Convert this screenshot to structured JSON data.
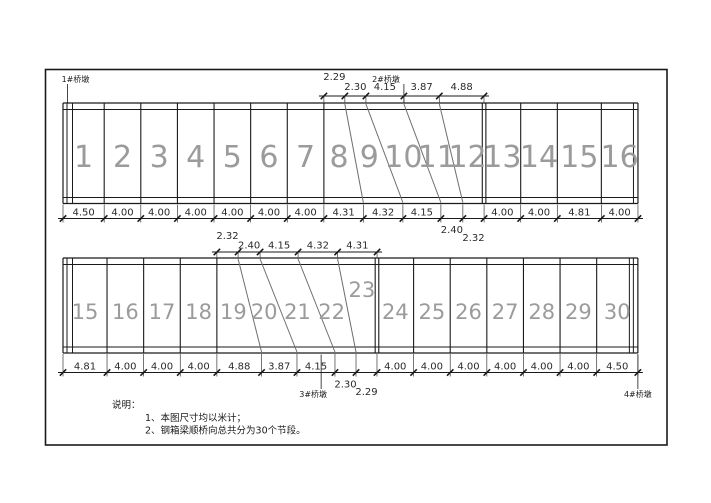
{
  "colors": {
    "line": "#1a1a1a",
    "dim_text": "#2a2a2a",
    "segment_number": "#9b9b9b",
    "diagonal": "#6e6e6e",
    "extension": "#3a3a3a"
  },
  "notes": {
    "title": "说明：",
    "items": [
      "1、本图尺寸均以米计；",
      "2、钢箱梁顺桥向总共分为30个节段。"
    ]
  },
  "girders": [
    {
      "id": "upper",
      "segments": [
        {
          "label": "1",
          "dim": "4.50"
        },
        {
          "label": "2",
          "dim": "4.00"
        },
        {
          "label": "3",
          "dim": "4.00"
        },
        {
          "label": "4",
          "dim": "4.00"
        },
        {
          "label": "5",
          "dim": "4.00"
        },
        {
          "label": "6",
          "dim": "4.00"
        },
        {
          "label": "7",
          "dim": "4.00"
        },
        {
          "label": "8",
          "dim": "4.31"
        },
        {
          "label": "9",
          "dim": "4.32"
        },
        {
          "label": "10",
          "dim": "4.15"
        },
        {
          "label": "11",
          "dim": "2.40"
        },
        {
          "label": "12",
          "dim": "2.32"
        },
        {
          "label": "13",
          "dim": "4.00"
        },
        {
          "label": "14",
          "dim": "4.00"
        },
        {
          "label": "15",
          "dim": "4.81"
        },
        {
          "label": "16",
          "dim": "4.00"
        }
      ],
      "dims_labeled_below": [
        10,
        11
      ],
      "top_dims": {
        "start_after_segment": 6,
        "values": [
          "2.29",
          "2.30",
          "4.15",
          "3.87",
          "4.88"
        ],
        "raised": [
          0
        ]
      },
      "skew_joints_after_segments": [
        7,
        8,
        9,
        10,
        11
      ],
      "piers": [
        {
          "label": "1#桥墩",
          "at_m": 0.5,
          "side": "top",
          "anchor": "start",
          "dx": -6
        },
        {
          "label": "2#桥墩",
          "at_m": 37.24,
          "side": "top",
          "anchor": "end",
          "dx": -4
        }
      ]
    },
    {
      "id": "lower",
      "segments": [
        {
          "label": "15",
          "dim": "4.81"
        },
        {
          "label": "16",
          "dim": "4.00"
        },
        {
          "label": "17",
          "dim": "4.00"
        },
        {
          "label": "18",
          "dim": "4.00"
        },
        {
          "label": "19",
          "dim": "4.88"
        },
        {
          "label": "20",
          "dim": "3.87"
        },
        {
          "label": "21",
          "dim": "4.15"
        },
        {
          "label": "22",
          "dim": "2.30"
        },
        {
          "label": "23",
          "dim": "2.29",
          "num_dy": -22
        },
        {
          "label": "24",
          "dim": "4.00"
        },
        {
          "label": "25",
          "dim": "4.00"
        },
        {
          "label": "26",
          "dim": "4.00"
        },
        {
          "label": "27",
          "dim": "4.00"
        },
        {
          "label": "28",
          "dim": "4.00"
        },
        {
          "label": "29",
          "dim": "4.00"
        },
        {
          "label": "30",
          "dim": "4.50"
        }
      ],
      "dims_labeled_below": [
        7,
        8
      ],
      "top_dims": {
        "start_after_segment": 3,
        "values": [
          "2.32",
          "2.40",
          "4.15",
          "4.32",
          "4.31"
        ],
        "raised": [
          0
        ]
      },
      "skew_joints_after_segments": [
        4,
        5,
        6,
        7,
        8
      ],
      "piers": [
        {
          "label": "3#桥墩",
          "at_m": 28.2,
          "side": "bottom",
          "anchor": "middle",
          "dx": -8
        },
        {
          "label": "4#桥墩",
          "at_m": 62.8,
          "side": "bottom",
          "anchor": "middle",
          "dx": 0
        }
      ]
    }
  ]
}
